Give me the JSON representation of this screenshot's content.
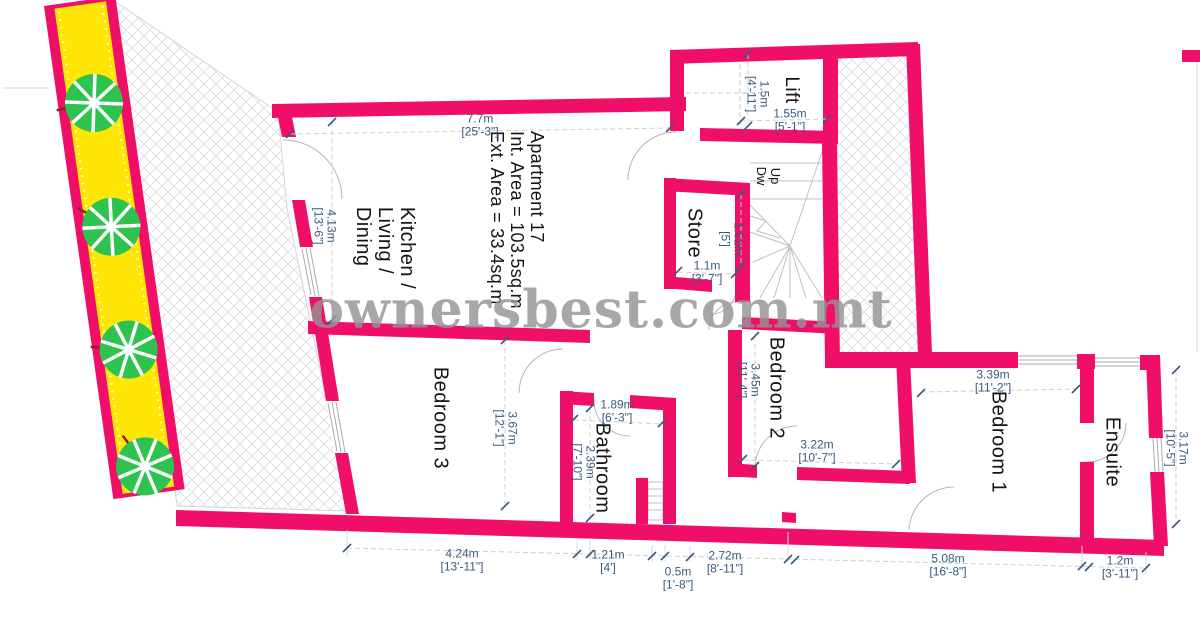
{
  "watermark": "ownersbest.com.mt",
  "apartment_info": {
    "line1": "Apartment 17",
    "line2": "Int. Area = 103.5sq.m",
    "line3": "Ext. Area = 33.4sq.m"
  },
  "rooms": {
    "kitchen_living_dining": {
      "line1": "Kitchen /",
      "line2": "Living /",
      "line3": "Dining"
    },
    "bedroom3": "Bedroom 3",
    "bathroom": "Bathroom",
    "bedroom2": "Bedroom 2",
    "bedroom1": "Bedroom 1",
    "ensuite": "Ensuite",
    "store": "Store",
    "lift": "Lift",
    "stairs": {
      "up": "Up",
      "down": "Dw"
    }
  },
  "dimensions": {
    "living_width": {
      "m": "7.7m",
      "ft": "[25'-3\"]"
    },
    "living_depth": {
      "m": "4.13m",
      "ft": "[13'-6\"]"
    },
    "bedroom3_depth": {
      "m": "3.67m",
      "ft": "[12'-1\"]"
    },
    "bedroom3_width": {
      "m": "4.24m",
      "ft": "[13'-11\"]"
    },
    "bathroom_width": {
      "m": "1.89m",
      "ft": "[6'-3\"]"
    },
    "bathroom_depth": {
      "m": "2.39m",
      "ft": "[7'-10\"]"
    },
    "bathroom_width_bottom": {
      "m": "1.21m",
      "ft": "[4']"
    },
    "shaft_width": {
      "m": "0.5m",
      "ft": "[1'-8\"]"
    },
    "corridor_width": {
      "m": "2.72m",
      "ft": "[8'-11\"]"
    },
    "bedroom2_depth": {
      "m": "3.45m",
      "ft": "[11'-4\"]"
    },
    "bedroom2_width": {
      "m": "3.22m",
      "ft": "[10'-7\"]"
    },
    "bedroom1_width": {
      "m": "3.39m",
      "ft": "[11'-2\"]"
    },
    "bedroom1_width_bottom": {
      "m": "5.08m",
      "ft": "[16'-8\"]"
    },
    "ensuite_depth": {
      "m": "3.17m",
      "ft": "[10'-5\"]"
    },
    "ensuite_width": {
      "m": "1.2m",
      "ft": "[3'-11\"]"
    },
    "lift_width": {
      "m": "1.55m",
      "ft": "[5'-1\"]"
    },
    "lift_depth": {
      "m": "1.5m",
      "ft": "[4'-11\"]"
    },
    "store_depth": {
      "m": "1.52m",
      "ft": "[5']"
    },
    "store_width": {
      "m": "1.1m",
      "ft": "[3'-7\"]"
    }
  },
  "colors": {
    "wall": "#F00F68",
    "planter_yellow": "#FFE607",
    "tree_green": "#2EC24F",
    "dimension_text": "#3A5A7C",
    "watermark_gray": "#949494",
    "hatch_gray": "#DDDDDD"
  }
}
